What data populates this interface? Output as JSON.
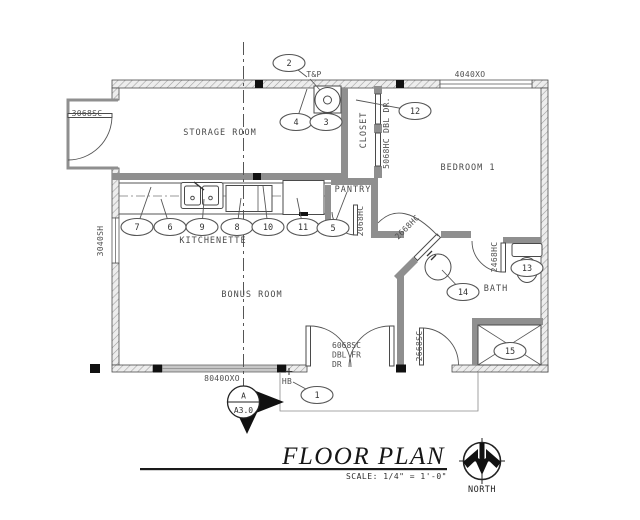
{
  "title": {
    "text": "FLOOR PLAN",
    "scale": "SCALE:  1/4\" = 1'-0\"",
    "north_label": "NORTH"
  },
  "section_marker": {
    "top": "A",
    "bottom": "A3.0"
  },
  "rooms": [
    {
      "name": "STORAGE ROOM",
      "x": 220,
      "y": 135,
      "rotate": 0
    },
    {
      "name": "KITCHENETTE",
      "x": 213,
      "y": 243,
      "rotate": 0
    },
    {
      "name": "BONUS ROOM",
      "x": 252,
      "y": 297,
      "rotate": 0
    },
    {
      "name": "BEDROOM 1",
      "x": 468,
      "y": 170,
      "rotate": 0
    },
    {
      "name": "PANTRY",
      "x": 353,
      "y": 192,
      "rotate": 0
    },
    {
      "name": "CLOSET",
      "x": 366,
      "y": 130,
      "rotate": -90
    },
    {
      "name": "BATH",
      "x": 496,
      "y": 291,
      "rotate": 0
    }
  ],
  "labels": [
    {
      "text": "3068SC",
      "x": 87,
      "y": 116,
      "rotate": 0
    },
    {
      "text": "3040SH",
      "x": 103,
      "y": 241,
      "rotate": -90
    },
    {
      "text": "4040XO",
      "x": 470,
      "y": 77,
      "rotate": 0
    },
    {
      "text": "8040OXO",
      "x": 222,
      "y": 381,
      "rotate": 0
    },
    {
      "text": "5068HC DBL DR.",
      "x": 389,
      "y": 133,
      "rotate": -90
    },
    {
      "text": "2068HC",
      "x": 363,
      "y": 221,
      "rotate": -90
    },
    {
      "text": "2668HC",
      "x": 409,
      "y": 229,
      "rotate": -45
    },
    {
      "text": "2468HC",
      "x": 497,
      "y": 257,
      "rotate": -90
    },
    {
      "text": "2668SC",
      "x": 422,
      "y": 346,
      "rotate": -90
    },
    {
      "text": "T&P",
      "x": 314,
      "y": 77,
      "rotate": 0
    },
    {
      "text": "HB",
      "x": 287,
      "y": 384,
      "rotate": 0
    }
  ],
  "multiline_labels": [
    {
      "lines": [
        "6068SC",
        "DBL FR",
        "DR"
      ],
      "x": 332,
      "y": 348,
      "line_h": 9.5
    }
  ],
  "callouts": [
    {
      "n": "2",
      "cx": 289,
      "cy": 63,
      "lx": 307,
      "ly": 77
    },
    {
      "n": "4",
      "cx": 296,
      "cy": 122,
      "lx": 307,
      "ly": 89
    },
    {
      "n": "3",
      "cx": 326,
      "cy": 122,
      "lx": 326,
      "ly": 112
    },
    {
      "n": "12",
      "cx": 415,
      "cy": 111,
      "lx": 356,
      "ly": 100
    },
    {
      "n": "7",
      "cx": 137,
      "cy": 227,
      "lx": 151,
      "ly": 187
    },
    {
      "n": "6",
      "cx": 170,
      "cy": 227,
      "lx": 161,
      "ly": 199
    },
    {
      "n": "9",
      "cx": 202,
      "cy": 227,
      "lx": 204,
      "ly": 199
    },
    {
      "n": "8",
      "cx": 237,
      "cy": 227,
      "lx": 241,
      "ly": 198
    },
    {
      "n": "10",
      "cx": 268,
      "cy": 227,
      "lx": 263,
      "ly": 186
    },
    {
      "n": "11",
      "cx": 303,
      "cy": 227,
      "lx": 297,
      "ly": 198
    },
    {
      "n": "5",
      "cx": 333,
      "cy": 228,
      "lx": 347,
      "ly": 192
    },
    {
      "n": "13",
      "cx": 527,
      "cy": 268
    },
    {
      "n": "14",
      "cx": 463,
      "cy": 292,
      "lx": 442,
      "ly": 270
    },
    {
      "n": "15",
      "cx": 510,
      "cy": 351
    },
    {
      "n": "1",
      "cx": 317,
      "cy": 395,
      "lx": 293,
      "ly": 382
    }
  ]
}
